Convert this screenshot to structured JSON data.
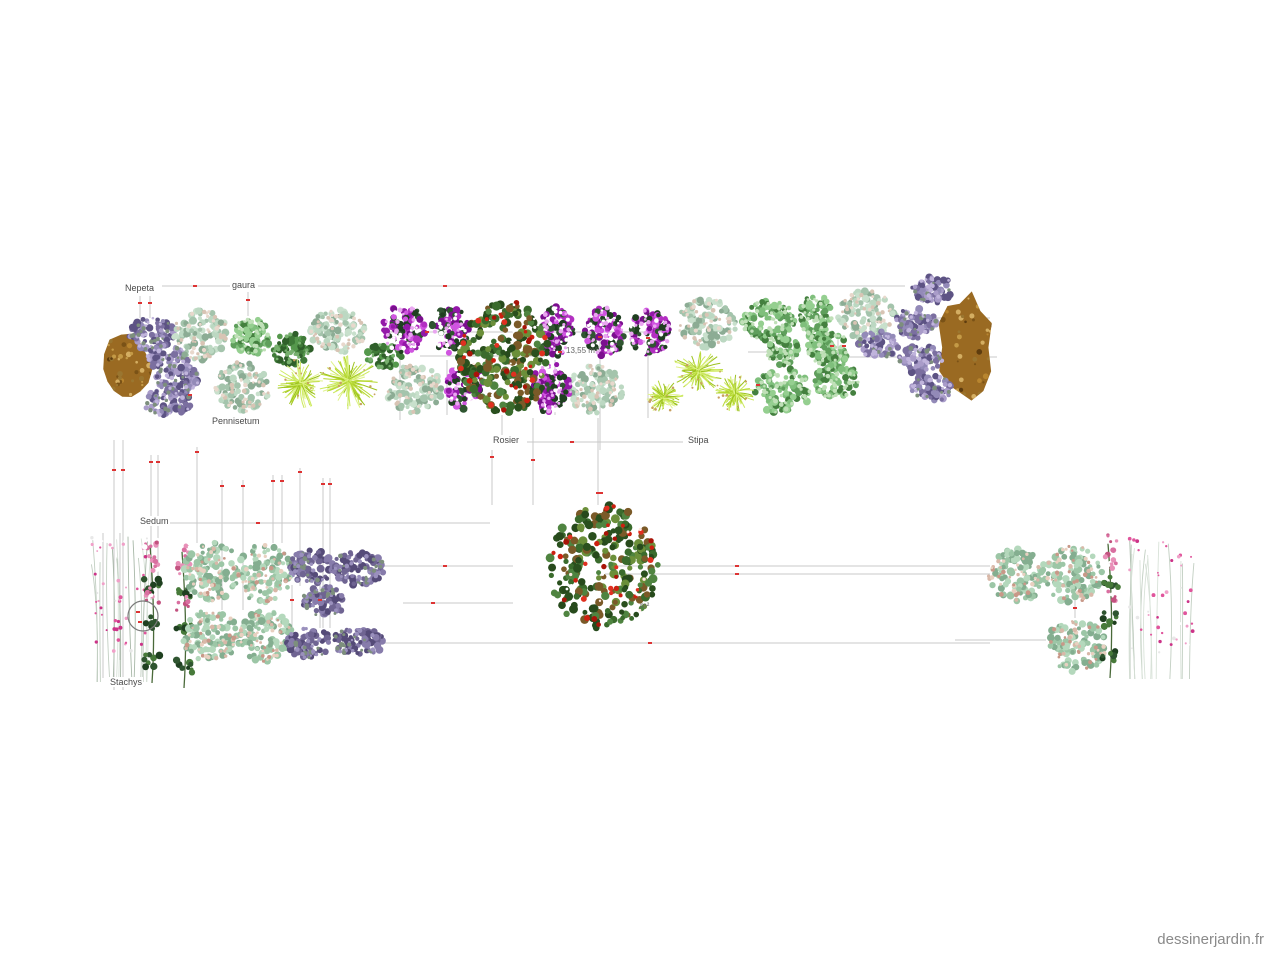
{
  "page": {
    "watermark": "dessinerjardin.fr",
    "background": "#ffffff"
  },
  "plan": {
    "labels": [
      {
        "text": "Nepeta",
        "x": 124,
        "y": 283
      },
      {
        "text": "gaura",
        "x": 231,
        "y": 280
      },
      {
        "text": "Pennisetum",
        "x": 211,
        "y": 416
      },
      {
        "text": "Rosier",
        "x": 492,
        "y": 435
      },
      {
        "text": "Stipa",
        "x": 687,
        "y": 435
      },
      {
        "text": "Sedum",
        "x": 139,
        "y": 516
      },
      {
        "text": "Stachys",
        "x": 109,
        "y": 677
      }
    ],
    "area_labels": [
      {
        "text": "13,55 m²",
        "x": 566,
        "y": 346
      },
      {
        "text": "m²",
        "x": 640,
        "y": 601
      }
    ],
    "line_color": "#c9c9c9",
    "tick_color": "#d33",
    "circle": {
      "cx": 143,
      "cy": 616,
      "r": 15,
      "stroke": "#7a7a7a"
    },
    "lines": [
      [
        162,
        286,
        230,
        286
      ],
      [
        258,
        286,
        905,
        286
      ],
      [
        140,
        296,
        140,
        318
      ],
      [
        150,
        296,
        150,
        318
      ],
      [
        248,
        292,
        248,
        316
      ],
      [
        385,
        332,
        668,
        332
      ],
      [
        420,
        356,
        545,
        356
      ],
      [
        748,
        352,
        788,
        352
      ],
      [
        838,
        340,
        838,
        362
      ],
      [
        900,
        318,
        990,
        318
      ],
      [
        843,
        357,
        997,
        357
      ],
      [
        527,
        442,
        683,
        442
      ],
      [
        400,
        355,
        400,
        420
      ],
      [
        447,
        360,
        447,
        415
      ],
      [
        555,
        360,
        555,
        415
      ],
      [
        600,
        332,
        600,
        450
      ],
      [
        648,
        355,
        648,
        418
      ],
      [
        502,
        415,
        502,
        437
      ],
      [
        492,
        450,
        492,
        505
      ],
      [
        533,
        418,
        533,
        505
      ],
      [
        598,
        418,
        598,
        505
      ],
      [
        114,
        440,
        114,
        690
      ],
      [
        123,
        440,
        123,
        690
      ],
      [
        151,
        455,
        151,
        600
      ],
      [
        158,
        455,
        158,
        600
      ],
      [
        197,
        447,
        197,
        543
      ],
      [
        222,
        480,
        222,
        610
      ],
      [
        243,
        480,
        243,
        610
      ],
      [
        273,
        475,
        273,
        543
      ],
      [
        282,
        475,
        282,
        543
      ],
      [
        300,
        468,
        300,
        586
      ],
      [
        323,
        478,
        323,
        628
      ],
      [
        330,
        478,
        330,
        628
      ],
      [
        170,
        523,
        490,
        523
      ],
      [
        378,
        566,
        513,
        566
      ],
      [
        605,
        566,
        990,
        566
      ],
      [
        605,
        574,
        990,
        574
      ],
      [
        403,
        603,
        513,
        603
      ],
      [
        380,
        643,
        990,
        643
      ],
      [
        955,
        640,
        1046,
        640
      ],
      [
        1075,
        600,
        1075,
        618
      ],
      [
        292,
        585,
        292,
        628
      ],
      [
        320,
        585,
        320,
        628
      ],
      [
        103,
        533,
        103,
        678
      ],
      [
        120,
        533,
        120,
        660
      ]
    ],
    "ticks": [
      [
        195,
        286
      ],
      [
        445,
        286
      ],
      [
        140,
        303
      ],
      [
        150,
        303
      ],
      [
        248,
        300
      ],
      [
        427,
        332
      ],
      [
        600,
        337
      ],
      [
        648,
        338
      ],
      [
        572,
        442
      ],
      [
        114,
        470
      ],
      [
        123,
        470
      ],
      [
        151,
        462
      ],
      [
        158,
        462
      ],
      [
        197,
        452
      ],
      [
        222,
        486
      ],
      [
        243,
        486
      ],
      [
        273,
        481
      ],
      [
        282,
        481
      ],
      [
        300,
        472
      ],
      [
        323,
        484
      ],
      [
        330,
        484
      ],
      [
        492,
        457
      ],
      [
        533,
        460
      ],
      [
        598,
        493
      ],
      [
        601,
        493
      ],
      [
        258,
        523
      ],
      [
        445,
        566
      ],
      [
        737,
        566
      ],
      [
        737,
        574
      ],
      [
        433,
        603
      ],
      [
        650,
        643
      ],
      [
        1075,
        608
      ],
      [
        292,
        600
      ],
      [
        320,
        600
      ],
      [
        138,
        612
      ],
      [
        140,
        622
      ],
      [
        832,
        346
      ],
      [
        844,
        346
      ],
      [
        758,
        385
      ],
      [
        190,
        395
      ],
      [
        560,
        352
      ]
    ],
    "plants": [
      {
        "t": "rock",
        "x": 98,
        "y": 330,
        "w": 58,
        "h": 78
      },
      {
        "t": "rock",
        "x": 934,
        "y": 289,
        "w": 62,
        "h": 117
      },
      {
        "t": "nepeta",
        "x": 128,
        "y": 318,
        "w": 46,
        "h": 32
      },
      {
        "t": "nepeta",
        "x": 146,
        "y": 344,
        "w": 42,
        "h": 26
      },
      {
        "t": "nepeta",
        "x": 156,
        "y": 365,
        "w": 44,
        "h": 28
      },
      {
        "t": "nepeta",
        "x": 143,
        "y": 388,
        "w": 48,
        "h": 28
      },
      {
        "t": "sage",
        "x": 173,
        "y": 310,
        "w": 56,
        "h": 50
      },
      {
        "t": "sage",
        "x": 215,
        "y": 362,
        "w": 54,
        "h": 50
      },
      {
        "t": "sage",
        "x": 310,
        "y": 310,
        "w": 56,
        "h": 42
      },
      {
        "t": "sage",
        "x": 386,
        "y": 365,
        "w": 56,
        "h": 48
      },
      {
        "t": "sage",
        "x": 568,
        "y": 365,
        "w": 56,
        "h": 48
      },
      {
        "t": "sage",
        "x": 678,
        "y": 298,
        "w": 58,
        "h": 50
      },
      {
        "t": "sage",
        "x": 838,
        "y": 291,
        "w": 58,
        "h": 48
      },
      {
        "t": "green_bush",
        "x": 231,
        "y": 318,
        "w": 42,
        "h": 36
      },
      {
        "t": "green_bush",
        "x": 740,
        "y": 300,
        "w": 55,
        "h": 40
      },
      {
        "t": "green_bush",
        "x": 767,
        "y": 336,
        "w": 32,
        "h": 30
      },
      {
        "t": "green_bush",
        "x": 755,
        "y": 368,
        "w": 55,
        "h": 46
      },
      {
        "t": "green_bush",
        "x": 799,
        "y": 294,
        "w": 33,
        "h": 44
      },
      {
        "t": "green_bush",
        "x": 806,
        "y": 331,
        "w": 44,
        "h": 34
      },
      {
        "t": "green_bush",
        "x": 815,
        "y": 363,
        "w": 44,
        "h": 36
      },
      {
        "t": "dark_green",
        "x": 272,
        "y": 333,
        "w": 38,
        "h": 32
      },
      {
        "t": "dark_green",
        "x": 366,
        "y": 344,
        "w": 36,
        "h": 24
      },
      {
        "t": "grass",
        "x": 277,
        "y": 357,
        "w": 48,
        "h": 52
      },
      {
        "t": "grass",
        "x": 317,
        "y": 352,
        "w": 64,
        "h": 58
      },
      {
        "t": "grass",
        "x": 642,
        "y": 380,
        "w": 42,
        "h": 34
      },
      {
        "t": "grass",
        "x": 671,
        "y": 350,
        "w": 54,
        "h": 42
      },
      {
        "t": "grass",
        "x": 714,
        "y": 374,
        "w": 42,
        "h": 38
      },
      {
        "t": "petunia",
        "x": 383,
        "y": 305,
        "w": 42,
        "h": 48
      },
      {
        "t": "petunia",
        "x": 431,
        "y": 307,
        "w": 38,
        "h": 46
      },
      {
        "t": "petunia",
        "x": 446,
        "y": 364,
        "w": 38,
        "h": 45
      },
      {
        "t": "petunia",
        "x": 531,
        "y": 363,
        "w": 40,
        "h": 50
      },
      {
        "t": "petunia",
        "x": 539,
        "y": 307,
        "w": 35,
        "h": 49
      },
      {
        "t": "petunia",
        "x": 584,
        "y": 307,
        "w": 40,
        "h": 49
      },
      {
        "t": "petunia",
        "x": 630,
        "y": 309,
        "w": 40,
        "h": 47
      },
      {
        "t": "rosier",
        "x": 459,
        "y": 300,
        "w": 90,
        "h": 115
      },
      {
        "t": "nepeta",
        "x": 912,
        "y": 277,
        "w": 44,
        "h": 26
      },
      {
        "t": "nepeta",
        "x": 894,
        "y": 308,
        "w": 42,
        "h": 30
      },
      {
        "t": "nepeta",
        "x": 858,
        "y": 331,
        "w": 42,
        "h": 27
      },
      {
        "t": "nepeta",
        "x": 898,
        "y": 345,
        "w": 44,
        "h": 29
      },
      {
        "t": "nepeta",
        "x": 911,
        "y": 375,
        "w": 42,
        "h": 26
      },
      {
        "t": "tall_pink",
        "x": 90,
        "y": 532,
        "w": 58,
        "h": 150
      },
      {
        "t": "tall_rose",
        "x": 136,
        "y": 533,
        "w": 32,
        "h": 150
      },
      {
        "t": "tall_rose",
        "x": 166,
        "y": 540,
        "w": 36,
        "h": 148
      },
      {
        "t": "sedum",
        "x": 184,
        "y": 542,
        "w": 56,
        "h": 60
      },
      {
        "t": "sedum",
        "x": 237,
        "y": 544,
        "w": 56,
        "h": 60
      },
      {
        "t": "sedum",
        "x": 182,
        "y": 610,
        "w": 56,
        "h": 52
      },
      {
        "t": "sedum",
        "x": 237,
        "y": 610,
        "w": 56,
        "h": 52
      },
      {
        "t": "purple_low",
        "x": 289,
        "y": 550,
        "w": 44,
        "h": 34
      },
      {
        "t": "purple_low",
        "x": 332,
        "y": 551,
        "w": 52,
        "h": 34
      },
      {
        "t": "purple_low",
        "x": 302,
        "y": 586,
        "w": 44,
        "h": 30
      },
      {
        "t": "purple_low",
        "x": 287,
        "y": 628,
        "w": 44,
        "h": 30
      },
      {
        "t": "purple_low",
        "x": 332,
        "y": 628,
        "w": 52,
        "h": 28
      },
      {
        "t": "rosier",
        "x": 548,
        "y": 505,
        "w": 110,
        "h": 125
      },
      {
        "t": "sedum",
        "x": 988,
        "y": 549,
        "w": 58,
        "h": 52
      },
      {
        "t": "sedum",
        "x": 1044,
        "y": 545,
        "w": 58,
        "h": 58
      },
      {
        "t": "sedum",
        "x": 1046,
        "y": 618,
        "w": 60,
        "h": 55
      },
      {
        "t": "tall_rose",
        "x": 1088,
        "y": 532,
        "w": 44,
        "h": 146
      },
      {
        "t": "tall_pink",
        "x": 1128,
        "y": 535,
        "w": 66,
        "h": 144
      }
    ],
    "plant_types": {
      "rock": {
        "style": "rock",
        "palette": [
          "#c49a46",
          "#7a5216",
          "#b8852f",
          "#5e3c0e",
          "#d4ae62",
          "#9a7630"
        ],
        "base": "#9a6a22"
      },
      "nepeta": {
        "style": "clump",
        "palette": [
          "#7b6fa0",
          "#938ab8",
          "#5d5384",
          "#a99cc9"
        ],
        "accent": [
          "#c0b4dc",
          "#7d8f7d"
        ]
      },
      "sage": {
        "style": "clump",
        "palette": [
          "#a4c4ac",
          "#bcd8c2",
          "#8cac94",
          "#c8e0cc"
        ],
        "accent": [
          "#d8c4b4",
          "#e8d8cc"
        ]
      },
      "green_bush": {
        "style": "clump",
        "palette": [
          "#5f9f5c",
          "#7fbf7c",
          "#44803f",
          "#95cf90"
        ],
        "accent": [
          "#c0e0b8"
        ]
      },
      "dark_green": {
        "style": "clump",
        "palette": [
          "#3f7a38",
          "#2f5f2a",
          "#55984c"
        ],
        "accent": [
          "#77b06e"
        ]
      },
      "petunia": {
        "style": "clump",
        "palette": [
          "#2f5530",
          "#1f3f20",
          "#b32fc2",
          "#9318a8",
          "#d055e0",
          "#7a0f8e"
        ],
        "accent": [
          "#e9a6f0",
          "#ffffff"
        ]
      },
      "sedum": {
        "style": "clump",
        "palette": [
          "#9cc6a6",
          "#b4d8bc",
          "#84ae90"
        ],
        "accent": [
          "#d8b8a8",
          "#e8d0c0",
          "#c89888"
        ]
      },
      "purple_low": {
        "style": "clump",
        "palette": [
          "#6f6492",
          "#877cab",
          "#554b78"
        ],
        "accent": [
          "#9a90bd",
          "#7d8f7d"
        ]
      },
      "rosier": {
        "style": "rosier",
        "palette": [
          "#3a6b2c",
          "#2a501e",
          "#4f8440",
          "#6b8f3a",
          "#274a1c",
          "#7a5a28"
        ],
        "flowers": [
          "#cc2010",
          "#a81408",
          "#e03020"
        ],
        "accent": [
          "#ffffff",
          "#ffe9e0"
        ]
      },
      "grass": {
        "style": "grass",
        "palette": [
          "#b6d832",
          "#cbe95e",
          "#9cc21e",
          "#dff28a"
        ],
        "accent": [
          "#c8a060"
        ]
      },
      "tall_pink": {
        "style": "tall_pink",
        "palette": [
          "#c2cfc2",
          "#d8e2d8",
          "#a8b8a8"
        ],
        "accent": [
          "#e0559c",
          "#cc3388",
          "#f0a0c8",
          "#ffffff",
          "#e8e8e8"
        ]
      },
      "tall_rose": {
        "style": "tall_rose",
        "palette": [
          "#2f5530",
          "#1f4020",
          "#477a3a"
        ],
        "accent": [
          "#d96fa0",
          "#e890b8",
          "#c2527f",
          "#ffffff"
        ]
      }
    }
  }
}
